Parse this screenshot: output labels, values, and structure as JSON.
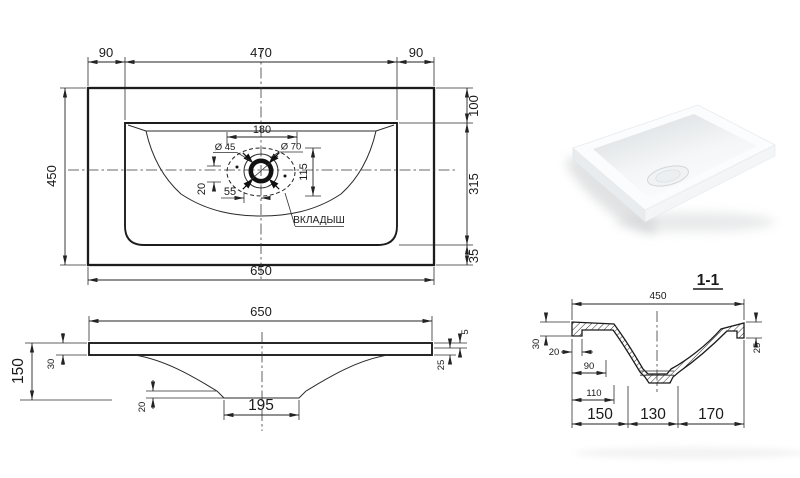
{
  "colors": {
    "background": "#ffffff",
    "line": "#1c1c1c",
    "photo_shadow": "#c4c6c8"
  },
  "plan_view": {
    "dim_overhang_left": "90",
    "dim_rim_width": "470",
    "dim_overhang_right": "90",
    "dim_total_depth": "450",
    "dim_total_width": "650",
    "dim_back_offset": "100",
    "dim_rim_depth": "315",
    "dim_front_offset": "35",
    "dim_insert_width": "180",
    "dim_drain_small": "Ø 45",
    "dim_drain_large": "Ø 70",
    "dim_insert_depth": "115",
    "dim_drain_offset_y": "20",
    "dim_drain_offset_x": "55",
    "insert_label": "ВКЛАДЫШ"
  },
  "front_view": {
    "dim_width": "650",
    "dim_height": "150",
    "dim_edge_thickness": "30",
    "dim_lip": "5",
    "dim_rim": "25",
    "dim_boss_height": "20",
    "dim_bottom_width": "195"
  },
  "section_view": {
    "title": "1-1",
    "dim_depth": "450",
    "dim_flange_height": "30",
    "dim_foot_width": "20",
    "dim_wall_offset": "90",
    "dim_bottom_offset": "110",
    "dim_seg_left": "150",
    "dim_seg_center": "130",
    "dim_seg_right": "170",
    "dim_right_edge": "25"
  }
}
